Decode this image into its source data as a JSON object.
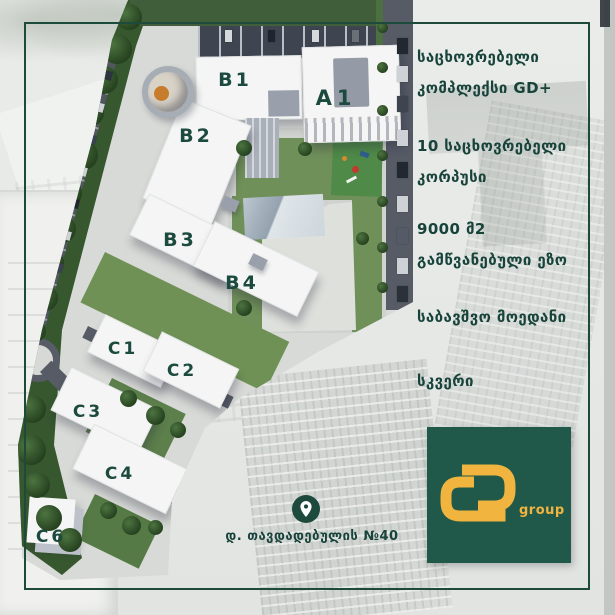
{
  "colors": {
    "brand_green": "#20584a",
    "brand_gold": "#f0b43f",
    "text_green": "#17433a",
    "border_green": "#1d4a3a"
  },
  "info_panel": {
    "groups": [
      {
        "lines": [
          "საცხოვრებელი",
          "კომპლექსი GD+"
        ]
      },
      {
        "lines": [
          "10 საცხოვრებელი",
          "კორპუსი"
        ]
      },
      {
        "lines": [
          "9000 მ2",
          "გამწვანებული ეზო"
        ]
      },
      {
        "lines": [
          "საბავშვო მოედანი"
        ]
      },
      {
        "lines": [
          "სკვერი"
        ]
      }
    ]
  },
  "site_plan": {
    "building_labels": [
      "A1",
      "B1",
      "B2",
      "B3",
      "B4",
      "C1",
      "C2",
      "C3",
      "C4",
      "C6"
    ]
  },
  "footer": {
    "address": "დ. თავდადებულის №40"
  },
  "logo": {
    "caption": "group"
  }
}
